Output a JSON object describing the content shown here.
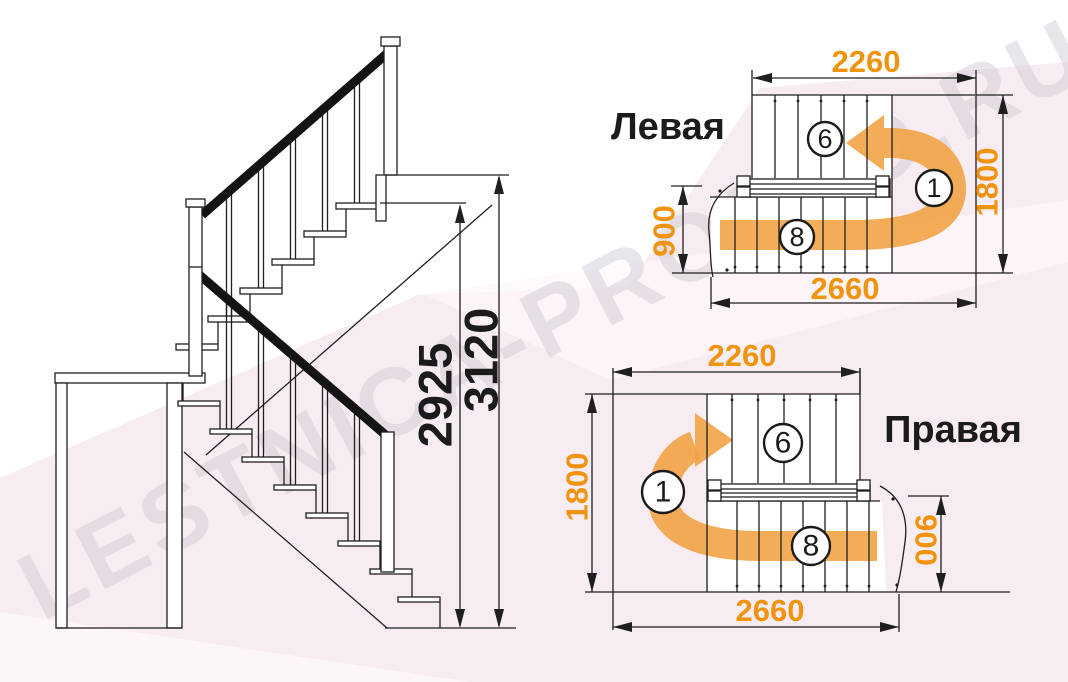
{
  "watermark": {
    "text": "LESTNICA-PROSTO.RU"
  },
  "colors": {
    "accent_orange": "#f0940f",
    "arrow_orange": "#f2a346",
    "line": "#1f1f1f",
    "background_pink": "#f8ecf3"
  },
  "elevation": {
    "dim_inner": "2925",
    "dim_outer": "3120"
  },
  "plans": {
    "left": {
      "title": "Левая",
      "dim_top": "2260",
      "dim_bottom": "2660",
      "dim_side": "1800",
      "dim_entry": "900",
      "steps_upper": "6",
      "steps_lower": "8",
      "step_first": "1"
    },
    "right": {
      "title": "Правая",
      "dim_top": "2260",
      "dim_bottom": "2660",
      "dim_side": "1800",
      "dim_entry": "900",
      "steps_upper": "6",
      "steps_lower": "8",
      "step_first": "1"
    }
  }
}
